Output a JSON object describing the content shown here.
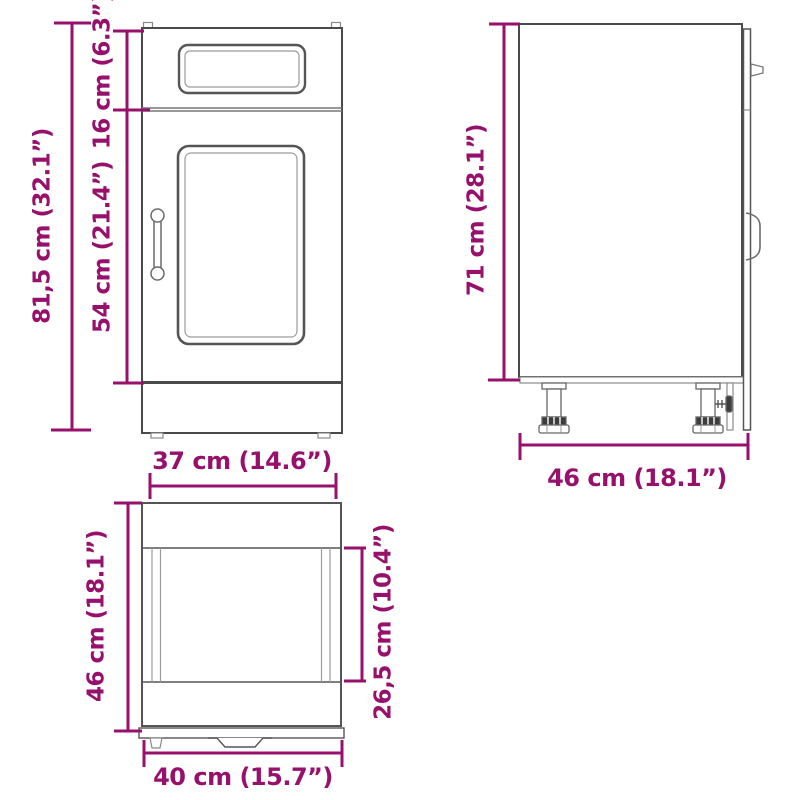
{
  "diagram_title": "kitchen base cabinet dimension drawing",
  "colors": {
    "dimension_accent": "#97106c",
    "outline_dark": "#4a4a4a",
    "outline_light": "#9b9b9b",
    "background": "#ffffff"
  },
  "views": {
    "front": {
      "total_height": "81,5 cm (32.1”)",
      "drawer_height": "16 cm (6.3”)",
      "door_height": "54 cm (21.4”)",
      "inner_width": "37 cm (14.6”)"
    },
    "side": {
      "body_height": "71 cm (28.1”)",
      "depth": "46 cm (18.1”)"
    },
    "top": {
      "outer_depth": "46 cm (18.1”)",
      "inner_depth": "26,5 cm (10.4”)",
      "outer_width": "40 cm (15.7”)"
    }
  }
}
